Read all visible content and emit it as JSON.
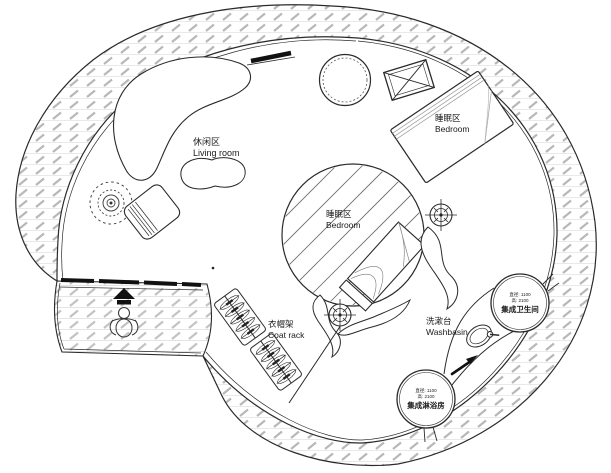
{
  "plan": {
    "areas": {
      "living_room": {
        "zh": "休闲区",
        "en": "Living room"
      },
      "bedroom_upper": {
        "zh": "睡眠区",
        "en": "Bedroom"
      },
      "bedroom_center": {
        "zh": "睡眠区",
        "en": "Bedroom"
      },
      "coat_rack": {
        "zh": "衣帽架",
        "en": "Coat rack"
      },
      "washbasin": {
        "zh": "洗漱台",
        "en": "Washbasin"
      }
    },
    "pods": {
      "toilet": {
        "diameter": "直径: 1100",
        "height": "高: 2100",
        "name": "集成卫生间"
      },
      "shower": {
        "diameter": "直径: 1100",
        "height": "高: 2100",
        "name": "集成淋浴房"
      }
    },
    "colors": {
      "line": "#2a2a2a",
      "wall_hatch": "#b8b8b8",
      "deck_hatch": "#c3c3c3",
      "door_panel": "#111111",
      "background": "#ffffff"
    }
  }
}
